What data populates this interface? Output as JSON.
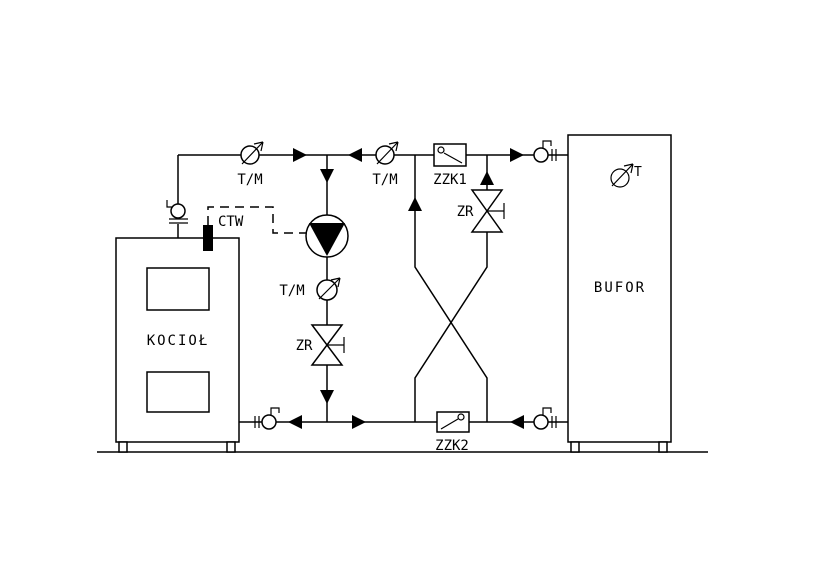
{
  "colors": {
    "line": "#000000",
    "background": "#ffffff",
    "symbol_fill": "#000000"
  },
  "labels": {
    "boiler": "KOCIOŁ",
    "buffer": "BUFOR",
    "buffer_temp_sensor": "T",
    "ctw_sensor": "CTW",
    "gauge_boiler_supply": "T/M",
    "gauge_mixed_supply": "T/M",
    "gauge_pump_outlet": "T/M",
    "valve_zzk1": "ZZK1",
    "valve_zzk2": "ZZK2",
    "valve_zr_pump_line": "ZR",
    "valve_zr_bypass": "ZR"
  }
}
